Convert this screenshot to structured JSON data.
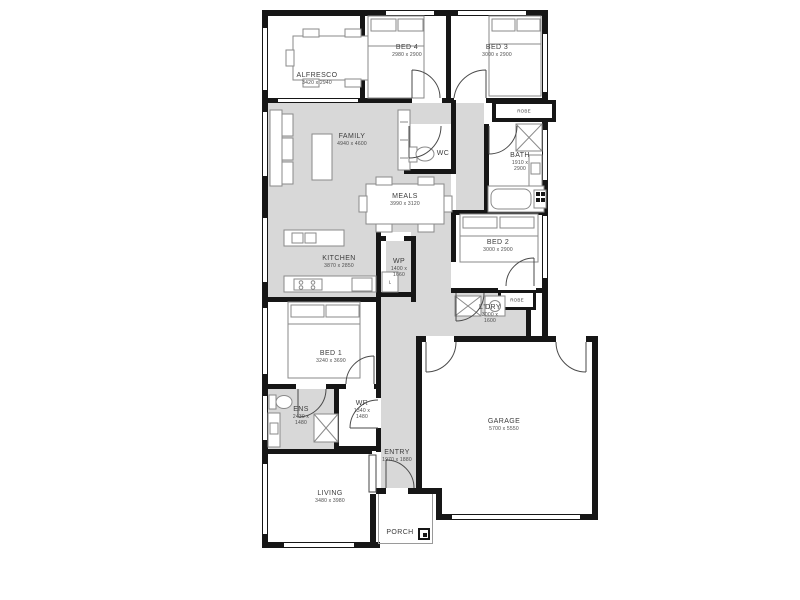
{
  "page": {
    "background": "#ffffff"
  },
  "plan_style": {
    "wall_color": "#161616",
    "zone_color": "#d8d8d8",
    "room_fill": "#ffffff",
    "furniture_stroke": "#8a8a8a",
    "door_stroke": "#4a4a4a",
    "label_color": "#3c3c3c"
  },
  "rooms": [
    {
      "name": "ALFRESCO",
      "dims": "3420 x 2940"
    },
    {
      "name": "BED 4",
      "dims": "2980 x 2900"
    },
    {
      "name": "BED 3",
      "dims": "3000 x 2900"
    },
    {
      "name": "FAMILY",
      "dims": "4940 x 4600"
    },
    {
      "name": "WC",
      "dims": ""
    },
    {
      "name": "BATH",
      "dims": "1910 x 2900"
    },
    {
      "name": "MEALS",
      "dims": "3990 x 3120"
    },
    {
      "name": "BED 2",
      "dims": "3000 x 2900"
    },
    {
      "name": "KITCHEN",
      "dims": "3870 x 2850"
    },
    {
      "name": "WP",
      "dims": "1400 x 1660"
    },
    {
      "name": "L'DRY",
      "dims": "3000 x 1600"
    },
    {
      "name": "ROBE",
      "dims": ""
    },
    {
      "name": "ROBE",
      "dims": ""
    },
    {
      "name": "BED 1",
      "dims": "3240 x 3690"
    },
    {
      "name": "ENS",
      "dims": "2430 x 1480"
    },
    {
      "name": "WR",
      "dims": "1340 x 1480"
    },
    {
      "name": "GARAGE",
      "dims": "5700 x 5550"
    },
    {
      "name": "ENTRY",
      "dims": "1970 x 1880"
    },
    {
      "name": "LIVING",
      "dims": "3480 x 3980"
    },
    {
      "name": "PORCH",
      "dims": ""
    },
    {
      "name": "L",
      "dims": ""
    }
  ]
}
